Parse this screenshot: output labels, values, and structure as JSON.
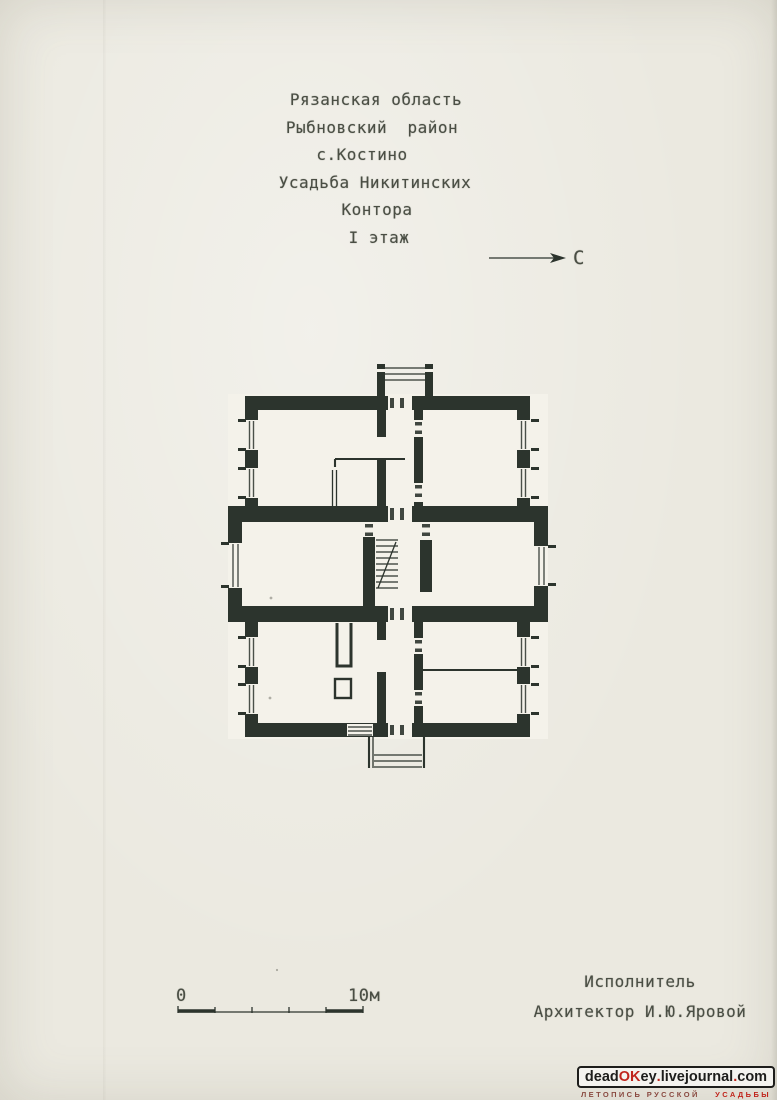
{
  "colors": {
    "paper": "#ebe9e0",
    "paper-light": "#f4f2ea",
    "ink": "#4a4e44",
    "wall": "#2c342d",
    "wm-dark": "#1d1d1b",
    "wm-red": "#c0251c",
    "wm-darkred": "#8a4a41"
  },
  "header": {
    "lines": [
      "Рязанская область",
      "Рыбновский  район",
      "с.Костино",
      "Усадьба Никитинских",
      "Контора",
      "I этаж"
    ]
  },
  "north": {
    "label": "С"
  },
  "scale_bar": {
    "zero_label": "0",
    "max_label": "10м"
  },
  "credits": {
    "role_line": "Исполнитель",
    "name_line": "Архитектор И.Ю.Яровой"
  },
  "watermark": {
    "segments": [
      {
        "text": "dead",
        "color": "#1d1d1b"
      },
      {
        "text": "OK",
        "color": "#c0251c"
      },
      {
        "text": "ey",
        "color": "#1d1d1b"
      },
      {
        "text": ".",
        "color": "#c0251c"
      },
      {
        "text": "livejournal",
        "color": "#1d1d1b"
      },
      {
        "text": ".",
        "color": "#c0251c"
      },
      {
        "text": "com",
        "color": "#1d1d1b"
      }
    ],
    "subtitle_left": "ЛЕТОПИСЬ РУССКОЙ",
    "subtitle_right": "УСАДЬБЫ"
  }
}
